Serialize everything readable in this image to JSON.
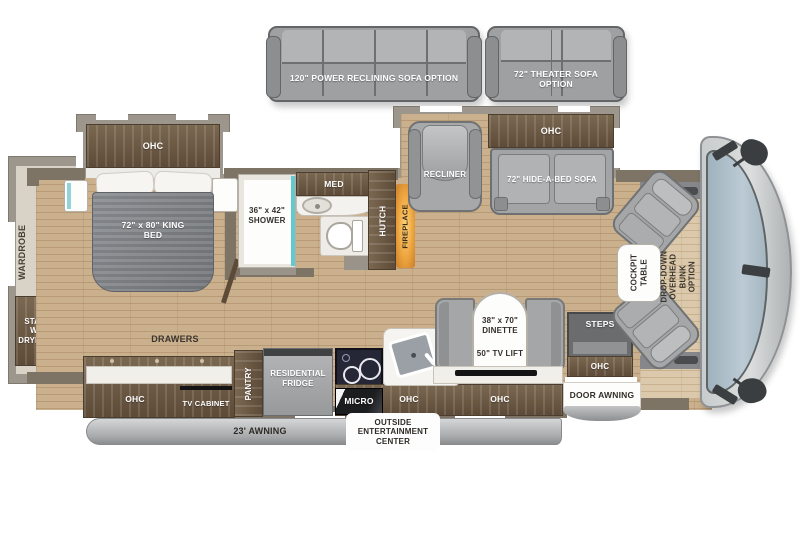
{
  "colors": {
    "floor_wood": "#c3a884",
    "wall": "#7d7466",
    "cabinet_wood": "#6b5945",
    "furniture_gray": "#a7a9ab",
    "shower_glass_teal": "#62c9cc",
    "fireplace_glow": "#eda43f",
    "windshield_blue": "#b3c3ce"
  },
  "optional_furniture": {
    "power_sofa_label": "120\" POWER RECLINING SOFA OPTION",
    "theater_sofa_label": "72\" THEATER SOFA OPTION"
  },
  "bedroom": {
    "overhead_cabinet": "OHC",
    "bed": "72\" x 80\" KING BED",
    "wardrobe": "WARDROBE",
    "washer_dryer": "STACKABLE WASHER/ DRYER OPTION",
    "drawers": "DRAWERS"
  },
  "bathroom": {
    "shower": "36\" x 42\" SHOWER",
    "medicine_cabinet": "MED",
    "hutch": "HUTCH",
    "fireplace": "FIREPLACE"
  },
  "living_area": {
    "recliner": "RECLINER",
    "overhead_cabinet": "OHC",
    "sofa": "72\" HIDE-A-BED SOFA"
  },
  "kitchen": {
    "overhead_cabinet_left": "OHC",
    "tv_cabinet": "TV CABINET",
    "pantry": "PANTRY",
    "fridge": "RESIDENTIAL FRIDGE",
    "microwave": "MICRO",
    "overhead_cabinet_mid": "OHC",
    "overhead_cabinet_right": "OHC"
  },
  "dinette": {
    "table": "38\" x 70\" DINETTE",
    "tv_lift": "50\" TV LIFT"
  },
  "entry": {
    "steps": "STEPS",
    "overhead_cabinet": "OHC",
    "door_awning": "DOOR AWNING"
  },
  "cockpit": {
    "table": "COCKPIT TABLE",
    "bunk_option": "DROP-DOWN OVERHEAD BUNK OPTION"
  },
  "exterior": {
    "awning": "23' AWNING",
    "entertainment_center": "OUTSIDE ENTERTAINMENT CENTER"
  }
}
